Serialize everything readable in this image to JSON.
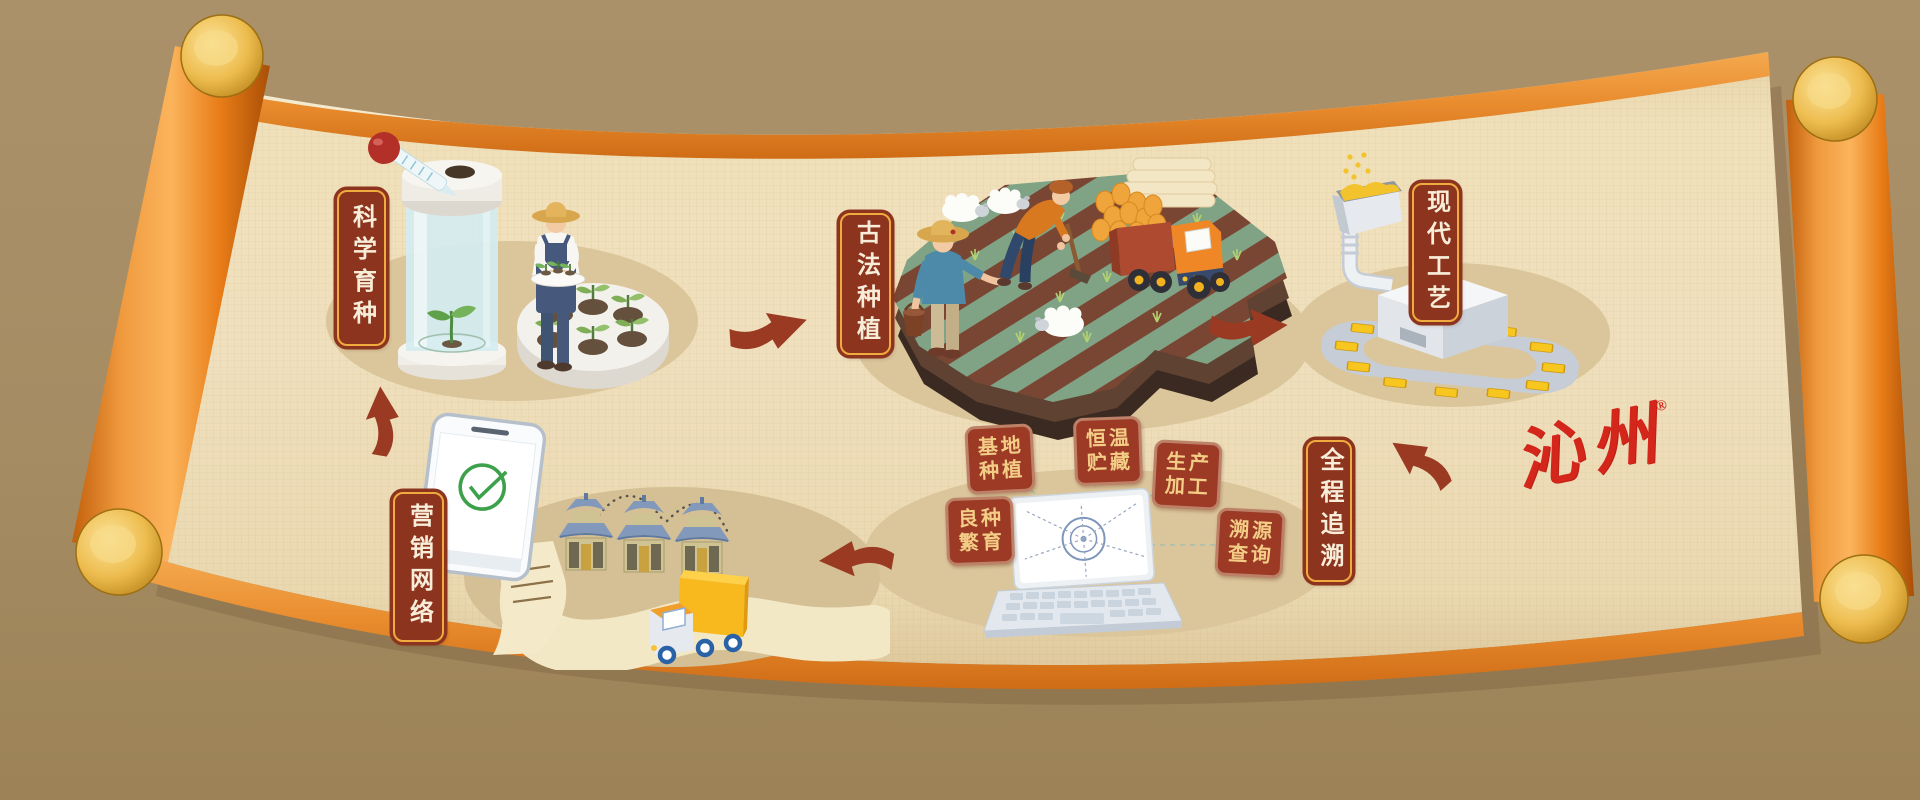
{
  "page": {
    "background_top": "#ab916a",
    "background_bottom": "#9c8256"
  },
  "scroll": {
    "paper_color": "#efdfbc",
    "trim_color": "#e88b2d",
    "roller_color": "#e87c17",
    "cap_color": "#edbc4e",
    "shadow_color": "#7e6845"
  },
  "flow": {
    "arrow_color": "#9a3a22",
    "plaque_style": {
      "background": "#8d341f",
      "border": "#f0ab3f",
      "text_color": "#f8edd8"
    },
    "stages": [
      {
        "id": "scientific-breeding",
        "label": "科学育种"
      },
      {
        "id": "traditional-planting",
        "label": "古法种植"
      },
      {
        "id": "modern-craft",
        "label": "现代工艺"
      },
      {
        "id": "full-traceability",
        "label": "全程追溯"
      },
      {
        "id": "marketing-network",
        "label": "营销网络"
      }
    ]
  },
  "trace_tags": {
    "style": {
      "background": "#9c3a26",
      "border": "#bd8168",
      "text_color": "#f3cd86"
    },
    "items": [
      {
        "line1": "基地",
        "line2": "种植"
      },
      {
        "line1": "恒温",
        "line2": "贮藏"
      },
      {
        "line1": "生产",
        "line2": "加工"
      },
      {
        "line1": "良种",
        "line2": "繁育"
      },
      {
        "line1": "溯源",
        "line2": "查询"
      }
    ]
  },
  "logo": {
    "text": "沁州",
    "registered": "®",
    "color": "#d5261b"
  },
  "scenes": [
    {
      "id": "scientific-breeding",
      "elements": [
        "pipette-icon",
        "culture-jar-icon",
        "farmer-with-tray",
        "seedling-planter"
      ]
    },
    {
      "id": "traditional-planting",
      "elements": [
        "terraced-field",
        "sheep",
        "farmer-with-bucket",
        "farmer-with-hoe",
        "harvest-truck"
      ]
    },
    {
      "id": "modern-craft",
      "elements": [
        "grain-hopper",
        "processing-machine",
        "conveyor-belt",
        "millet-packs"
      ]
    },
    {
      "id": "full-traceability",
      "elements": [
        "laptop",
        "radar-target",
        "dashed-links"
      ]
    },
    {
      "id": "marketing-network",
      "elements": [
        "smartphone",
        "check-receipt",
        "shop-buildings",
        "delivery-truck",
        "road"
      ]
    }
  ]
}
